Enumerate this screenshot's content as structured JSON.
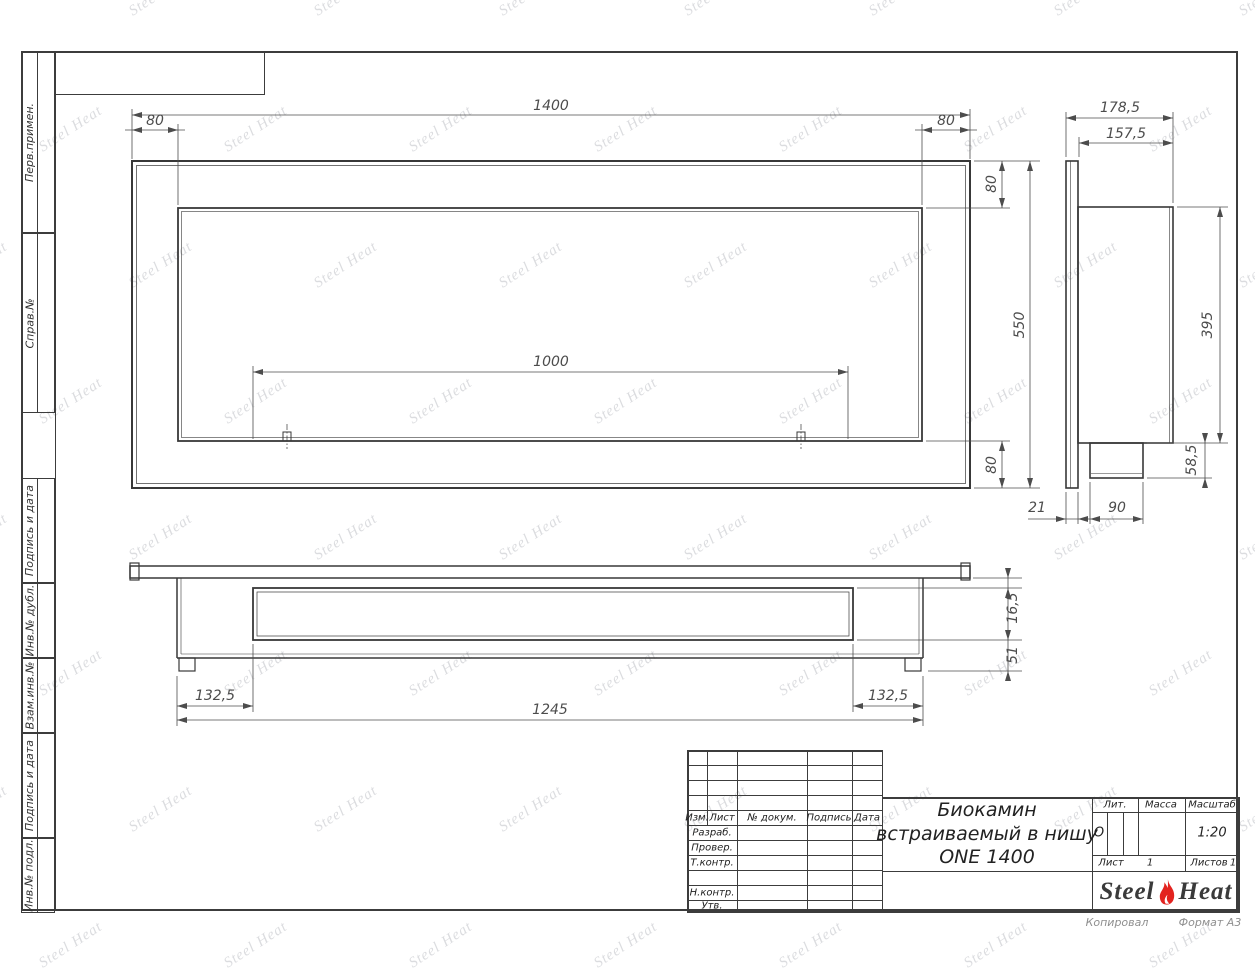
{
  "margin_labels": [
    "Перв.примен.",
    "Справ.№",
    "Подпись и дата",
    "Инв.№ дубл.",
    "Взам.инв.№",
    "Подпись и дата",
    "Инв.№ подл."
  ],
  "views": {
    "front": {
      "dims": {
        "width_total": "1400",
        "offset_left": "80",
        "offset_right": "80",
        "top_band": "80",
        "height_total": "550",
        "burner_length": "1000",
        "bottom_band": "80"
      }
    },
    "side": {
      "dims": {
        "depth_total": "178,5",
        "depth_body": "157,5",
        "body_height": "395",
        "box_height": "58,5",
        "flange_thickness": "21",
        "box_depth": "90"
      }
    },
    "top": {
      "dims": {
        "left_offset": "132,5",
        "body_width": "1245",
        "right_offset": "132,5",
        "flange_gap": "16,5",
        "back_depth": "51"
      }
    }
  },
  "title_block": {
    "revision_header": [
      "Изм.",
      "Лист",
      "№ докум.",
      "Подпись",
      "Дата"
    ],
    "rows": [
      "Разраб.",
      "Провер.",
      "Т.контр.",
      "",
      "Н.контр.",
      "Утв."
    ],
    "title_line1": "Биокамин",
    "title_line2": "встраиваемый в нишу",
    "title_line3": "ONE 1400",
    "lit_label": "Лит.",
    "lit_value": "О",
    "massa_label": "Масса",
    "masshtab_label": "Масштаб",
    "scale_value": "1:20",
    "list_label": "Лист",
    "list_value": "1",
    "listov_label": "Листов",
    "listov_value": "1",
    "logo_steel": "Steel",
    "logo_heat": "Heat"
  },
  "footer": {
    "left": "Копировал",
    "right": "Формат А3"
  },
  "watermark": {
    "text": "Steel Heat"
  },
  "colors": {
    "line": "#3c3c3c",
    "dim": "#4c4c4c",
    "logo_red": "#e3231f"
  }
}
